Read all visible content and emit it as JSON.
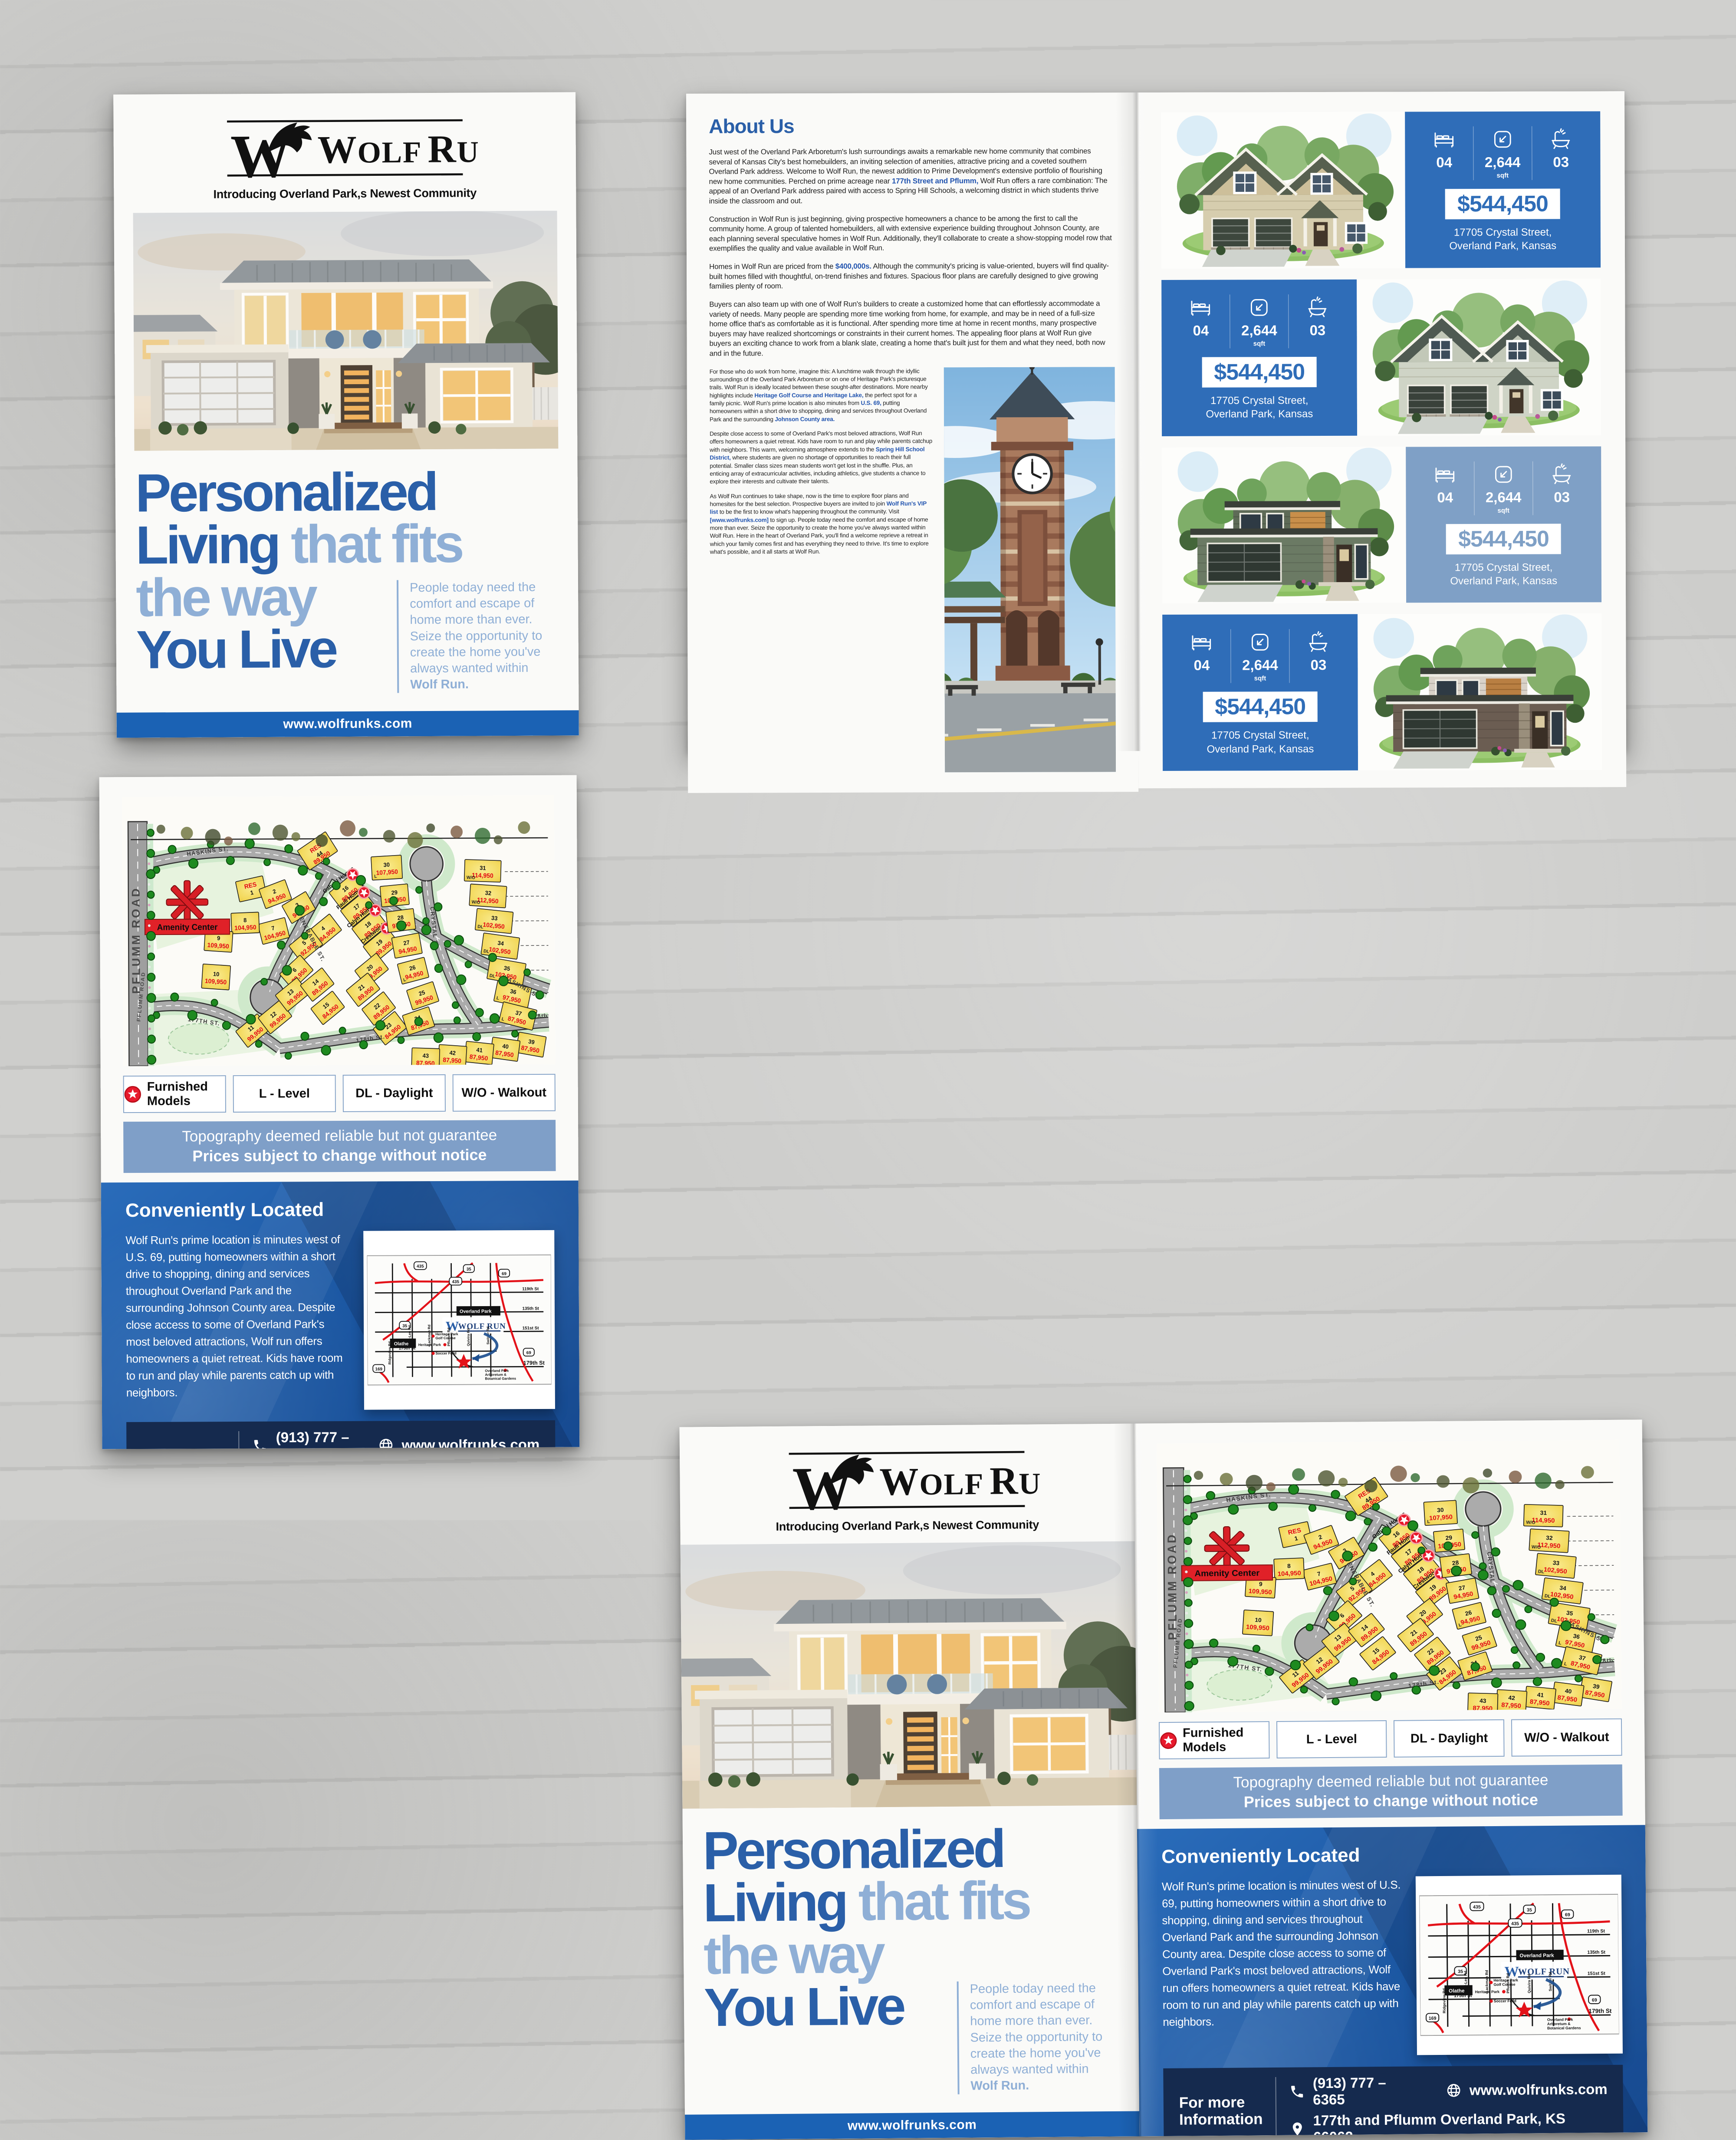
{
  "brand": {
    "monogram": "W",
    "name": "WOLF RUN",
    "logo": {
      "w": "W",
      "olf": "OLF",
      "r": "R",
      "un": "UN"
    },
    "tagline": "Introducing Overland Park,s Newest Community",
    "website": "www.wolfrunks.com"
  },
  "colors": {
    "primary_blue": "#2a5fa8",
    "light_blue": "#8fafd6",
    "bar_blue": "#1b62b4",
    "card_blue": "#2f6db8",
    "card_steel": "#7fa0c6",
    "topo_blue": "#7f9fc8",
    "navy": "#152a4e",
    "price_red": "#e30613",
    "lot_yellow": "#f3d95c"
  },
  "cover": {
    "headline_line1": "Personalized",
    "headline_line2_dark": "Living",
    "headline_line2_light": "that fits",
    "headline_line3": "the way",
    "headline_line4": "You Live",
    "blurb": "People today need the comfort and escape of home more than ever. Seize the opportunity to create the home you've always wanted within",
    "blurb_bold": "Wolf Run."
  },
  "about": {
    "title": "About Us",
    "p1": [
      {
        "t": "Just west of the Overland Park Arboretum's lush surroundings awaits a remarkable new home community that combines several of Kansas City's best homebuilders, an inviting selection of amenities, attractive pricing and a coveted southern Overland Park address.  Welcome to Wolf Run, the newest addition to Prime Development's extensive portfolio of flourishing new home communities. Perched on prime acreage near "
      },
      {
        "t": "177th Street and Pflumm,",
        "b": true
      },
      {
        "t": " Wolf Run offers a rare combination: The appeal of an Overland Park address paired with access to Spring Hill Schools, a welcoming district in which students thrive inside the classroom and out."
      }
    ],
    "p2": [
      {
        "t": "Construction in Wolf Run is just beginning, giving prospective homeowners a chance to be among the first to call  the community home. A group of talented homebuilders, all with extensive experience building throughout Johnson County, are each planning several speculative homes in Wolf Run. Additionally, they'll collaborate to create a show-stopping model row that exemplifies the quality and value available in Wolf Run."
      }
    ],
    "p3": [
      {
        "t": "Homes in Wolf Run are priced from the "
      },
      {
        "t": "$400,000s.",
        "b": true
      },
      {
        "t": " Although the community's pricing is value-oriented, buyers will find quality-built homes filled with thoughtful, on-trend finishes and fixtures. Spacious floor plans are carefully designed to give growing families plenty of room."
      }
    ],
    "p4": [
      {
        "t": "Buyers can also team up with one of Wolf Run's builders to create a customized home that can effortlessly accommodate a variety of needs. Many people are spending more time working from home, for example, and may be in need of a full-size home office that's as comfortable as it is functional. After spending more time at home in recent months, many prospective buyers may have realized shortcomings or constraints in their current homes. The appealing floor plans at Wolf Run give buyers an exciting chance to work from a blank slate, creating a home that's built just for them and what they need, both now and in the future."
      }
    ],
    "p5": [
      {
        "t": "For those who do work from home, imagine this: A lunchtime walk through the idyllic surroundings of the Overland Park Arboretum or on one of Heritage Park's picturesque trails. Wolf Run is ideally located between these sought-after destinations. More nearby highlights include "
      },
      {
        "t": "Heritage Golf Course and Heritage Lake,",
        "b": true
      },
      {
        "t": " the perfect spot for a family picnic.  Wolf Run's prime location is also minutes from "
      },
      {
        "t": "U.S. 69,",
        "b": true
      },
      {
        "t": " putting homeowners within a short drive to shopping, dining and services throughout Overland Park and the surrounding "
      },
      {
        "t": "Johnson County area.",
        "b": true
      }
    ],
    "p6": [
      {
        "t": "Despite close access to some of Overland Park's most beloved attractions, Wolf Run offers homeowners a quiet retreat. Kids have room to run and play while parents catchup with neighbors. This warm, welcoming atmosphere extends to the "
      },
      {
        "t": "Spring Hill School District,",
        "b": true
      },
      {
        "t": " where students are given no shortage of opportunities to reach their full potential. Smaller class sizes mean students won't get lost in the shuffle. Plus, an enticing array of extracurricular activities, including athletics, give students a chance to explore their interests and cultivate their talents."
      }
    ],
    "p7": [
      {
        "t": "As Wolf Run continues to take shape, now is the time to explore floor plans and homesites for the best selection. Prospective buyers are invited to join "
      },
      {
        "t": "Wolf Run's VIP list",
        "b": true
      },
      {
        "t": " to be the first to know what's happening throughout the community. Visit "
      },
      {
        "t": "[www.wolfrunks.com]",
        "b": true
      },
      {
        "t": " to sign up. People today need the comfort and escape of home more than ever. Seize the opportunity to create the home you've always wanted within Wolf Run. Here in the heart of Overland Park, you'll find a welcome reprieve  a retreat in which your family comes first and has everything they need to thrive. It's time to explore what's possible, and it all starts at Wolf Run."
      }
    ]
  },
  "listings": {
    "cards": [
      {
        "beds": "04",
        "sqft": "2,644",
        "sqft_unit": "sqft",
        "baths": "03",
        "price": "$544,450",
        "addr1": "17705 Crystal Street,",
        "addr2": "Overland Park, Kansas"
      },
      {
        "beds": "04",
        "sqft": "2,644",
        "sqft_unit": "sqft",
        "baths": "03",
        "price": "$544,450",
        "addr1": "17705 Crystal Street,",
        "addr2": "Overland Park, Kansas"
      },
      {
        "beds": "04",
        "sqft": "2,644",
        "sqft_unit": "sqft",
        "baths": "03",
        "price": "$544,450",
        "addr1": "17705 Crystal Street,",
        "addr2": "Overland Park, Kansas"
      },
      {
        "beds": "04",
        "sqft": "2,644",
        "sqft_unit": "sqft",
        "baths": "03",
        "price": "$544,450",
        "addr1": "17705 Crystal Street,",
        "addr2": "Overland Park, Kansas"
      }
    ]
  },
  "map_page": {
    "legend": [
      {
        "icon": "star",
        "label": "Furnished Models"
      },
      {
        "label": "L - Level"
      },
      {
        "label": "DL - Daylight"
      },
      {
        "label": "W/O - Walkout"
      }
    ],
    "disclaimer_line1": "Topography deemed reliable but not guarantee",
    "disclaimer_line2": "Prices subject to change without notice",
    "located": {
      "title": "Conveniently Located",
      "body": "Wolf Run's prime location is minutes west of U.S. 69, putting homeowners within a short drive to shopping, dining and services throughout Overland Park and the surrounding Johnson County area. Despite close access to some of Overland Park's most beloved attractions, Wolf run offers homeowners a quiet retreat. Kids have room to run and play while parents catch up with neighbors.",
      "info_line1": "For more",
      "info_line2": "Information",
      "phone": "(913) 777 – 6365",
      "website": "www.wolfrunks.com",
      "address": "177th and Pflumm Overland Park, KS 66062"
    },
    "plat": {
      "road_left": "PFLUMM ROAD",
      "street_haskins": "HASKINS ST.",
      "street_venerable": "VENERABLE ST.",
      "street_crystal": "CRYSTAL ST.",
      "street_177": "177TH ST.",
      "street_178": "178th St.",
      "street_178b": "178th",
      "amenity_label": "Amenity Center",
      "res_label": "RES",
      "lots": [
        {
          "n": "1",
          "price": "",
          "res": true
        },
        {
          "n": "2",
          "price": "94,950"
        },
        {
          "n": "3",
          "price": "94,950"
        },
        {
          "n": "4",
          "price": "84,950"
        },
        {
          "n": "5",
          "price": "92,950"
        },
        {
          "n": "6",
          "price": "89,950"
        },
        {
          "n": "7",
          "price": "104,950"
        },
        {
          "n": "8",
          "price": "104,950"
        },
        {
          "n": "9",
          "price": "109,950"
        },
        {
          "n": "10",
          "price": "109,950"
        },
        {
          "n": "11",
          "price": "99,950"
        },
        {
          "n": "12",
          "price": "99,950"
        },
        {
          "n": "13",
          "price": "99,950"
        },
        {
          "n": "14",
          "price": "89,950"
        },
        {
          "n": "15",
          "price": "84,950"
        },
        {
          "n": "16",
          "price": "89,950",
          "star": true,
          "builder": "Gabriel Homes"
        },
        {
          "n": "17",
          "price": "89,950",
          "star": true,
          "builder": "Pauli Homes"
        },
        {
          "n": "18",
          "price": "89,950",
          "star": true,
          "builder": "Calyn Homes"
        },
        {
          "n": "19",
          "price": "89,950",
          "star": true,
          "builder": "Crestwood"
        },
        {
          "n": "20",
          "price": "89,950"
        },
        {
          "n": "21",
          "price": "89,950"
        },
        {
          "n": "22",
          "price": "89,950"
        },
        {
          "n": "23",
          "price": "84,950"
        },
        {
          "n": "24",
          "price": "87,950"
        },
        {
          "n": "25",
          "price": "99,950"
        },
        {
          "n": "26",
          "price": "94,950",
          "tag": "L"
        },
        {
          "n": "27",
          "price": "94,950"
        },
        {
          "n": "28",
          "price": "97,950"
        },
        {
          "n": "29",
          "price": "102,950"
        },
        {
          "n": "30",
          "price": "107,950",
          "tag": "L"
        },
        {
          "n": "31",
          "price": "114,950",
          "tag": "W/O"
        },
        {
          "n": "32",
          "price": "112,950",
          "tag": "W/O"
        },
        {
          "n": "33",
          "price": "102,950",
          "tag": "DL"
        },
        {
          "n": "34",
          "price": "102,950",
          "tag": "DL"
        },
        {
          "n": "35",
          "price": "102,950",
          "tag": "DL"
        },
        {
          "n": "36",
          "price": "97,950",
          "tag": "L"
        },
        {
          "n": "37",
          "price": "87,950",
          "tag": "L"
        },
        {
          "n": "39",
          "price": "87,950"
        },
        {
          "n": "40",
          "price": "87,950"
        },
        {
          "n": "41",
          "price": "87,950"
        },
        {
          "n": "42",
          "price": "87,950"
        },
        {
          "n": "43",
          "price": "87,950"
        },
        {
          "n": "44",
          "price": "89,950",
          "res": true
        }
      ]
    },
    "minimap": {
      "brand": "WOLF RUN",
      "city1": "Overland Park",
      "city2": "Olathe",
      "st119": "119th St",
      "st135": "135th St",
      "st151": "151st St",
      "st175": "175th St",
      "st179": "179th St",
      "rd_ridgeview": "Ridgeview Rd",
      "rd_murlen": "Mur-Len Rd",
      "rd_lackman": "Lackman Rd",
      "rd_pflumm": "Pflumm Rd",
      "rd_quivira": "Quivira Rd",
      "rd_switzer": "Switzer Rd",
      "poi_golf1": "Heritage Park",
      "poi_golf2": "Golf Course",
      "poi_park": "Heritage Park",
      "poi_soccer": "Soccer Field",
      "poi_arb1": "Overland Park",
      "poi_arb2": "Arboretum &",
      "poi_arb3": "Botanical Gardens",
      "hw435": "435",
      "hw35": "35",
      "hw69": "69",
      "hw169": "169"
    }
  }
}
